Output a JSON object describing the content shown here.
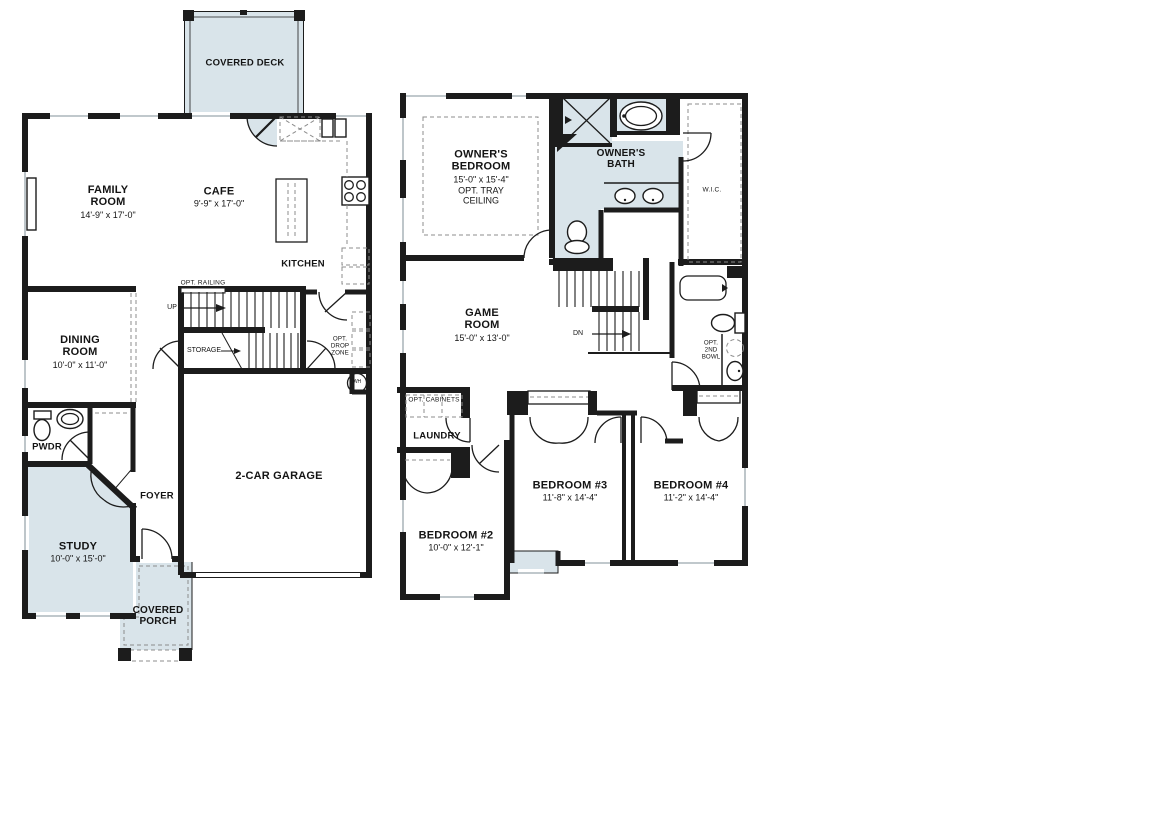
{
  "colors": {
    "wall": "#1c1c1c",
    "shaded_fill": "#d9e4ea",
    "dashed_line": "#8c8c8c",
    "window_line": "#9aa7ad",
    "background": "#ffffff"
  },
  "first_floor": {
    "rooms": {
      "covered_deck": {
        "label": "COVERED DECK"
      },
      "family_room": {
        "label": "FAMILY ROOM",
        "dims": "14'-9\" x 17'-0\""
      },
      "cafe": {
        "label": "CAFE",
        "dims": "9'-9\" x 17'-0\""
      },
      "kitchen": {
        "label": "KITCHEN"
      },
      "dining_room": {
        "label": "DINING ROOM",
        "dims": "10'-0\" x 11'-0\""
      },
      "powder": {
        "label": "PWDR"
      },
      "foyer": {
        "label": "FOYER"
      },
      "study": {
        "label": "STUDY",
        "dims": "10'-0\" x 15'-0\""
      },
      "covered_porch": {
        "label": "COVERED PORCH"
      },
      "garage": {
        "label": "2-CAR GARAGE"
      }
    },
    "annotations": {
      "opt_railing": "OPT. RAILING",
      "up": "UP",
      "storage": "STORAGE",
      "opt_drop_zone": "OPT. DROP ZONE",
      "water_heater": "WH"
    }
  },
  "second_floor": {
    "rooms": {
      "owners_bedroom": {
        "label": "OWNER'S BEDROOM",
        "dims": "15'-0\" x 15'-4\"",
        "note": "OPT. TRAY CEILING"
      },
      "owners_bath": {
        "label": "OWNER'S BATH"
      },
      "wic": {
        "label": "W.I.C."
      },
      "game_room": {
        "label": "GAME ROOM",
        "dims": "15'-0\" x 13'-0\""
      },
      "laundry": {
        "label": "LAUNDRY"
      },
      "bedroom_2": {
        "label": "BEDROOM #2",
        "dims": "10'-0\" x 12'-1\""
      },
      "bedroom_3": {
        "label": "BEDROOM #3",
        "dims": "11'-8\" x 14'-4\""
      },
      "bedroom_4": {
        "label": "BEDROOM #4",
        "dims": "11'-2\" x 14'-4\""
      }
    },
    "annotations": {
      "dn": "DN",
      "opt_cabinets": "OPT. CABINETS",
      "opt_2nd_bowl": "OPT. 2ND BOWL"
    }
  }
}
